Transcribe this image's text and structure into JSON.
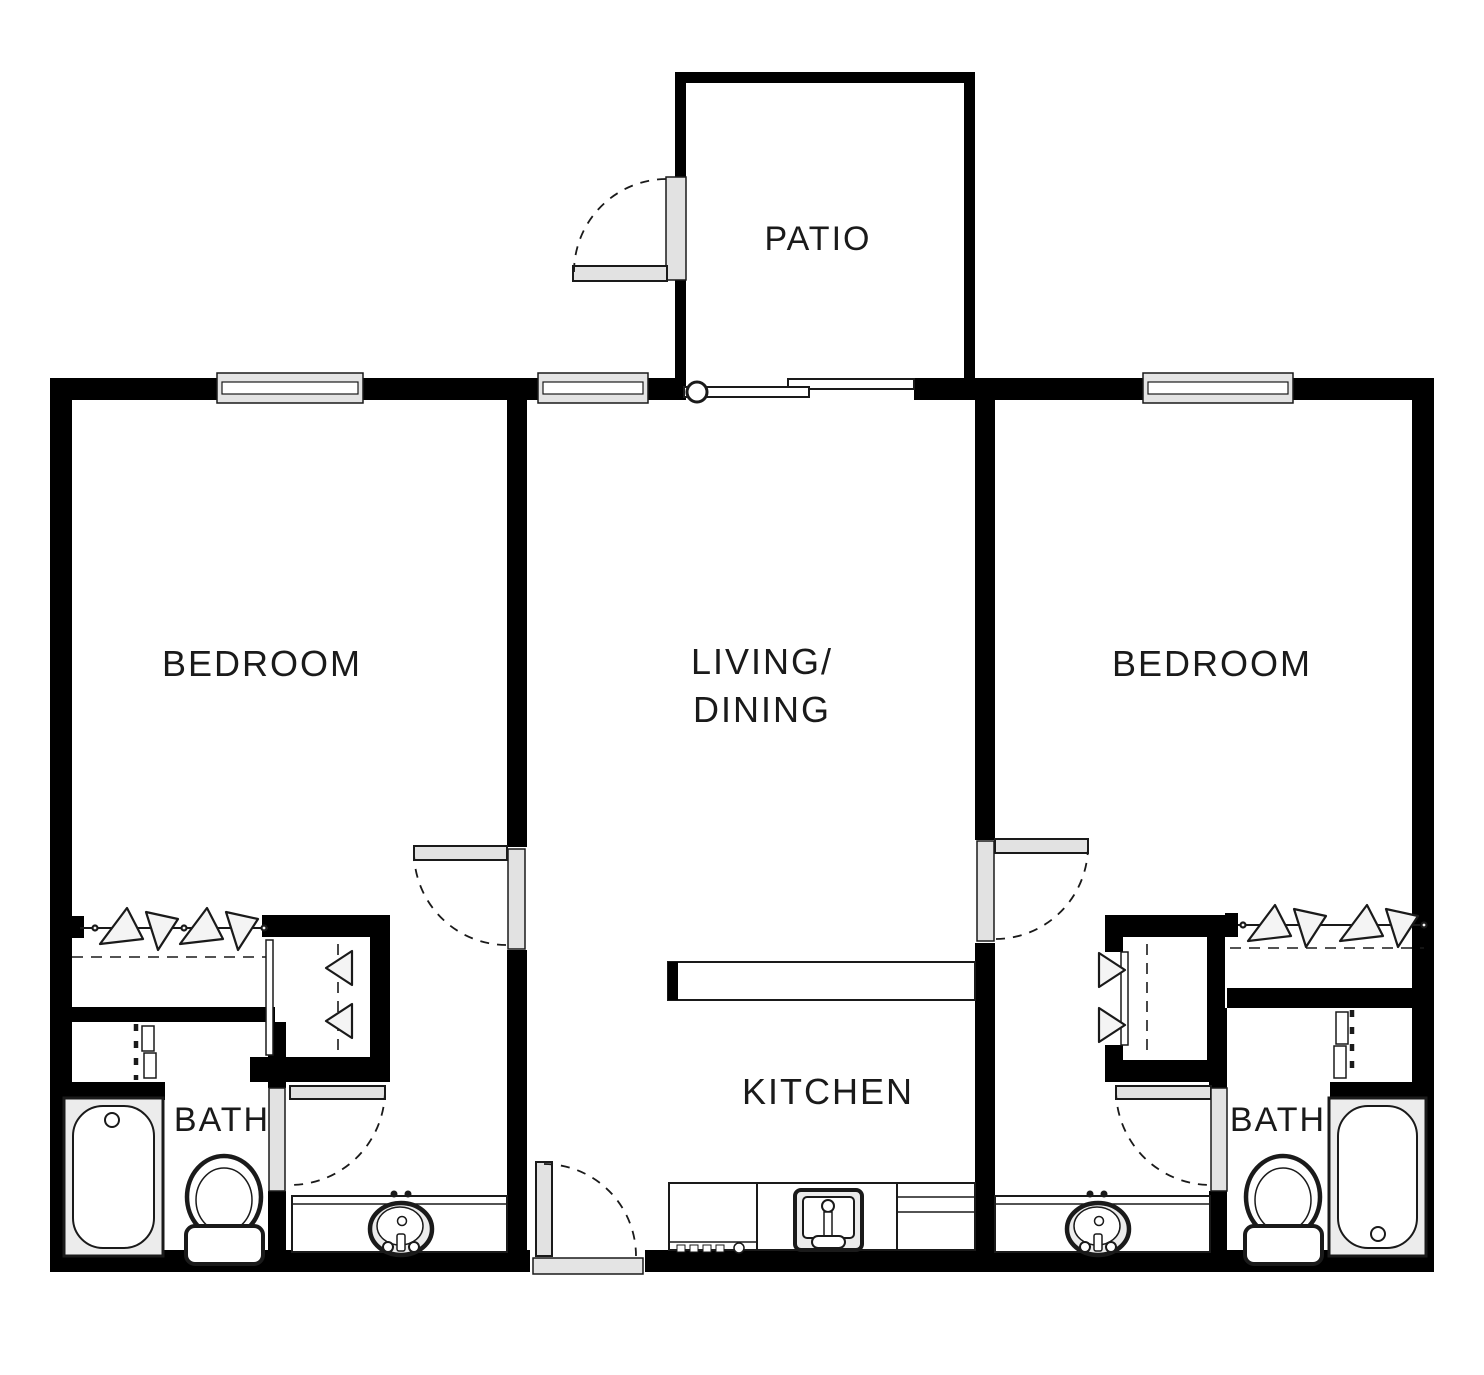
{
  "plan": {
    "type": "apartment-floor-plan",
    "rooms": {
      "patio": "PATIO",
      "bedroom_left": "BEDROOM",
      "bedroom_right": "BEDROOM",
      "living_line1": "LIVING/",
      "living_line2": "DINING",
      "kitchen": "KITCHEN",
      "bath_left": "BATH",
      "bath_right": "BATH"
    }
  },
  "colors": {
    "wall": "#000000",
    "line": "#1a1a1a",
    "window_fill": "#e4e4e4",
    "door_fill": "#e2e2e2",
    "fixture_fill": "#ececec",
    "bg": "#ffffff"
  }
}
